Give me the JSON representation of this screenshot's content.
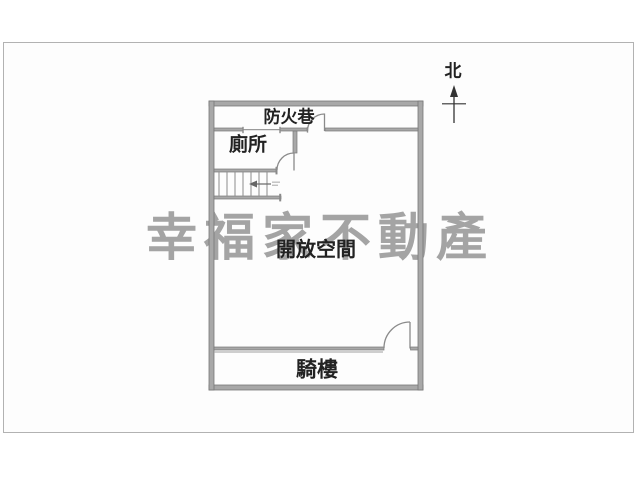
{
  "canvas": {
    "background": "#ffffff",
    "frame_border_color": "#b2b2b2"
  },
  "watermark": {
    "text": "幸福家不動產",
    "color": "#a4a4a4"
  },
  "north_indicator": {
    "label": "北"
  },
  "rooms": {
    "fire_lane": {
      "label": "防火巷"
    },
    "toilet": {
      "label": "廁所"
    },
    "open_space": {
      "label": "開放空間"
    },
    "arcade": {
      "label": "騎樓"
    }
  },
  "plan": {
    "colors": {
      "wall_fill": "#a8a8a8",
      "wall_edge": "#777777",
      "thin_line": "#8a8a8a",
      "label_text": "#222222",
      "north_mark": "#333333"
    }
  }
}
